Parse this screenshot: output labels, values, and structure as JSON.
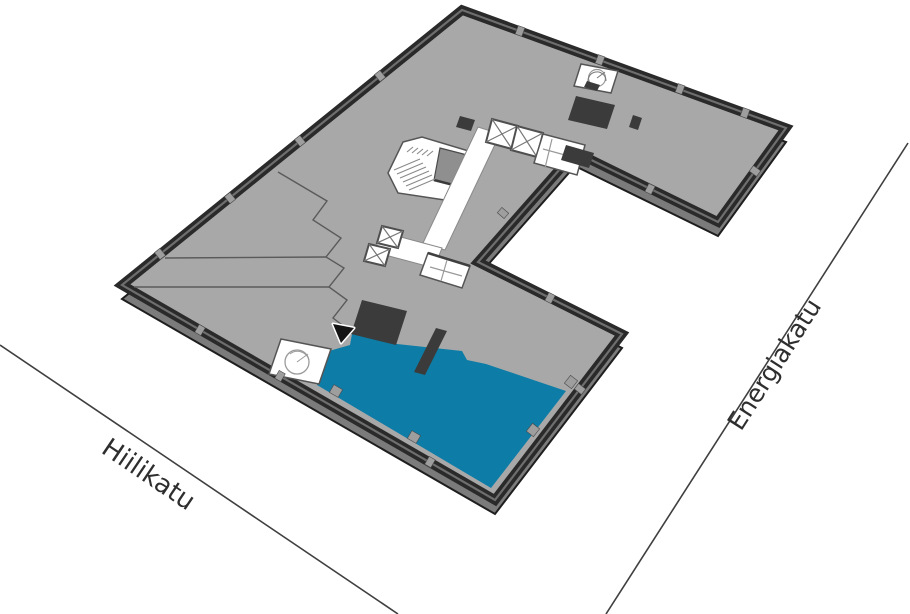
{
  "map": {
    "streets": [
      {
        "name": "Hiilikatu"
      },
      {
        "name": "Energiakatu"
      }
    ],
    "marker": {
      "shape": "triangle"
    },
    "colors": {
      "background": "#ffffff",
      "floor": "#a8a8a8",
      "wall": "#2a2a2a",
      "wall_top": "#6e6e6e",
      "slab_side": "#7b7b7b",
      "room_fill": "#ffffff",
      "dark_room": "#3b3b3b",
      "stair_void": "#8f8f8f",
      "highlight": "#0d7ca6",
      "marker_fill": "#141414",
      "street_line": "#3f3f3f",
      "street_label": "#2e2e2e"
    }
  }
}
